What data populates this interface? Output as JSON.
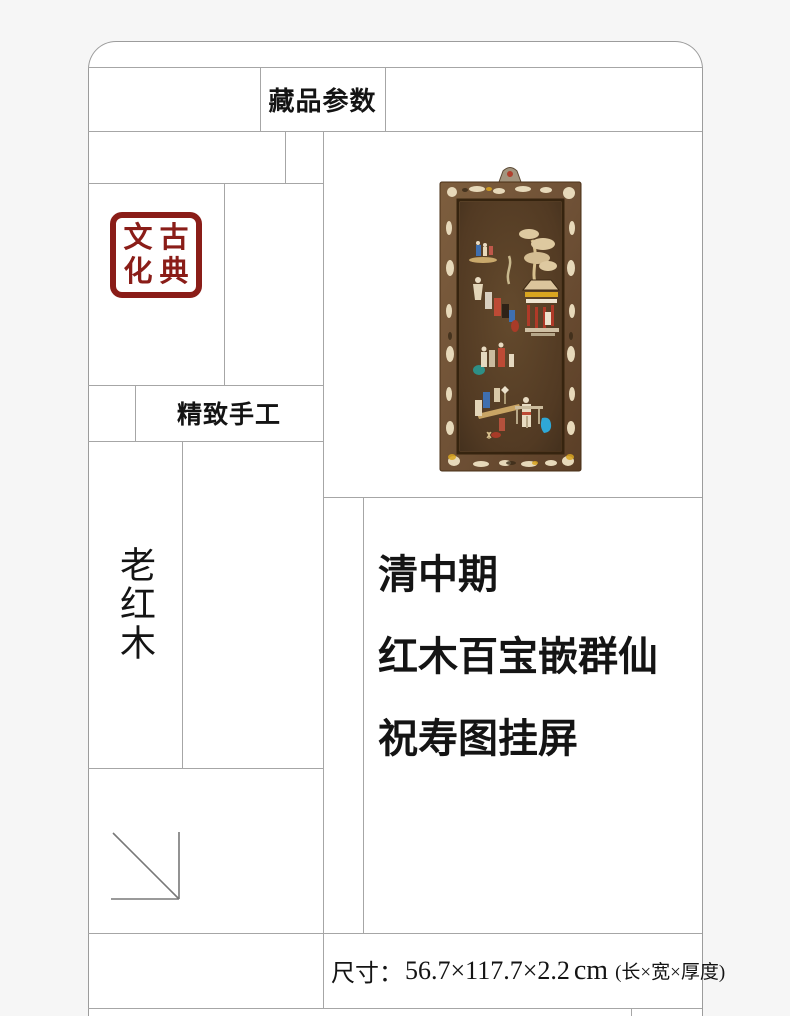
{
  "theme": {
    "page_bg": "#f6f6f6",
    "card_bg": "#ffffff",
    "line_color": "#a6a6a6",
    "ink": "#141414",
    "seal_red": "#8a1d18"
  },
  "header": {
    "params_title": "藏品参数"
  },
  "seal": {
    "text": "古典文化",
    "grid": [
      "文",
      "古",
      "化",
      "典"
    ]
  },
  "labels": {
    "craft": "精致手工",
    "material": "老红木"
  },
  "title": {
    "lines": [
      "清中期",
      "红木百宝嵌群仙",
      "祝寿图挂屏"
    ]
  },
  "dimensions": {
    "label": "尺寸：",
    "value": "56.7×117.7×2.2",
    "unit": "cm",
    "note": "(长×宽×厚度)"
  },
  "artwork_palette": {
    "frame_wood": "#6f5136",
    "panel_wood": "#523a23",
    "inlay_ivory": "#e7d9ba",
    "accent_blue": "#2fa8d6",
    "accent_red": "#b03a28",
    "accent_yellow": "#d9a520"
  }
}
